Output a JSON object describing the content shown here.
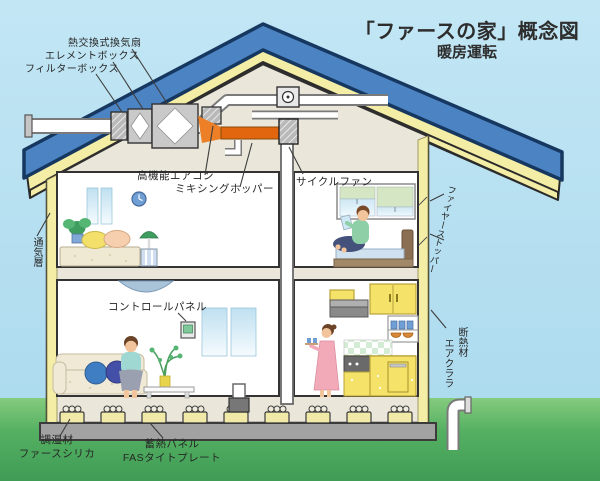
{
  "title": {
    "main": "「ファースの家」概念図",
    "subtitle": "暖房運転"
  },
  "labels": {
    "heat_exchange_fan": "熱交換式換気扇",
    "element_box": "エレメントボックス",
    "filter_box": "フィルターボックス",
    "high_performance_aircon": "高機能エアコン",
    "mixing_hopper": "ミキシングホッパー",
    "cycle_fan": "サイクルファン",
    "fire_stopper": "ファイヤーストッパー",
    "ventilation_layer": "通気層",
    "insulation_line1": "断熱材",
    "insulation_line2": "エアクララ",
    "control_panel": "コントロールパネル",
    "humidity_line1": "調湿材",
    "humidity_line2": "ファースシリカ",
    "storage_line1": "蓄熱パネル",
    "storage_line2": "FASタイトプレート"
  },
  "colors": {
    "sky": "#b3def0",
    "grass": "#4fa95e",
    "roof_blue": "#4c83c3",
    "roof_outline": "#16375f",
    "insulation_yellow": "#f3eda5",
    "wall_cream": "#eae7da",
    "heated_air_orange": "#e2660e",
    "foundation_gray": "#a2a2a2",
    "label_text": "#262626"
  }
}
